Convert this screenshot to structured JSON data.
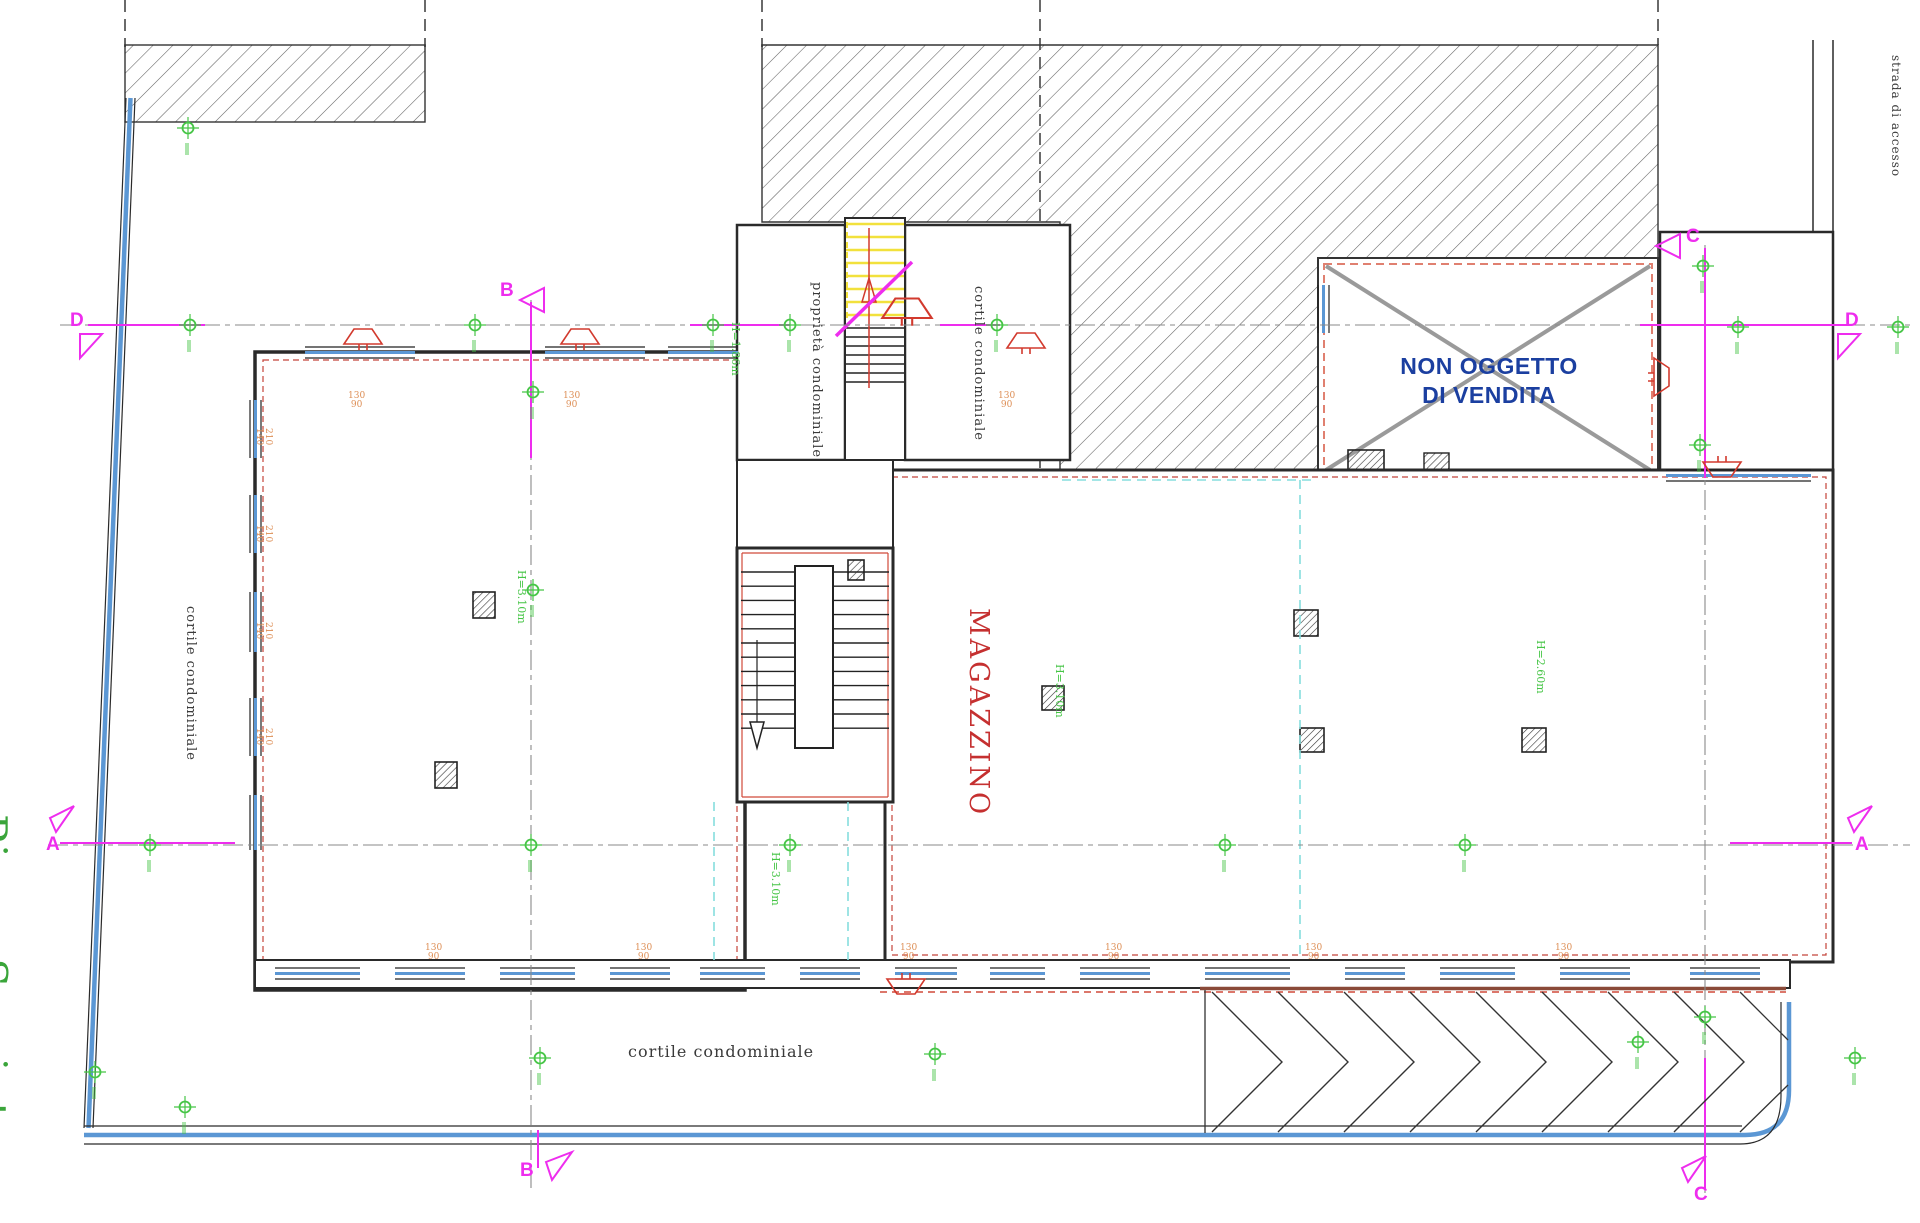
{
  "title": {
    "plan_title": "Piano Seminterrato"
  },
  "rooms": {
    "magazzino": "MAGAZZINO",
    "non_oggetto_line1": "NON OGGETTO",
    "non_oggetto_line2": "DI VENDITA",
    "proprieta_condominiale": "proprietà condominiale",
    "cortile_condominiale_top": "cortile condominiale",
    "cortile_condominiale_left": "cortile condominiale",
    "cortile_condominiale_bottom": "cortile condominiale",
    "strada_di_accesso": "strada di accesso"
  },
  "section_markers": {
    "a": "A",
    "b": "B",
    "c": "C",
    "d": "D"
  },
  "height_labels": [
    "H=1.86m",
    "H=3.10m",
    "H=3.10m",
    "H=3.10m",
    "H=2.60m"
  ],
  "window_dimensions": [
    "130/90",
    "130/90",
    "130/90",
    "210/140",
    "210/140",
    "210/140",
    "210/140",
    "130/90",
    "130/90",
    "130/90",
    "130/90",
    "130/90",
    "130/90"
  ],
  "colors": {
    "wall": "#2a2a2a",
    "section_magenta": "#ee2dee",
    "survey_green": "#46c546",
    "window_blue": "#5b97d4",
    "cyan_dashed": "#86dede",
    "red_symbol": "#d23a2e",
    "salmon_dashed": "#e08070",
    "brown_wall": "#8a4a38",
    "dimension_orange": "#dd8e55",
    "label_blue": "#1b3fa0",
    "label_red": "#c53030",
    "title_green": "#3aa53a",
    "hatch_gray": "#606060",
    "cross_gray": "#9a9a9a"
  }
}
